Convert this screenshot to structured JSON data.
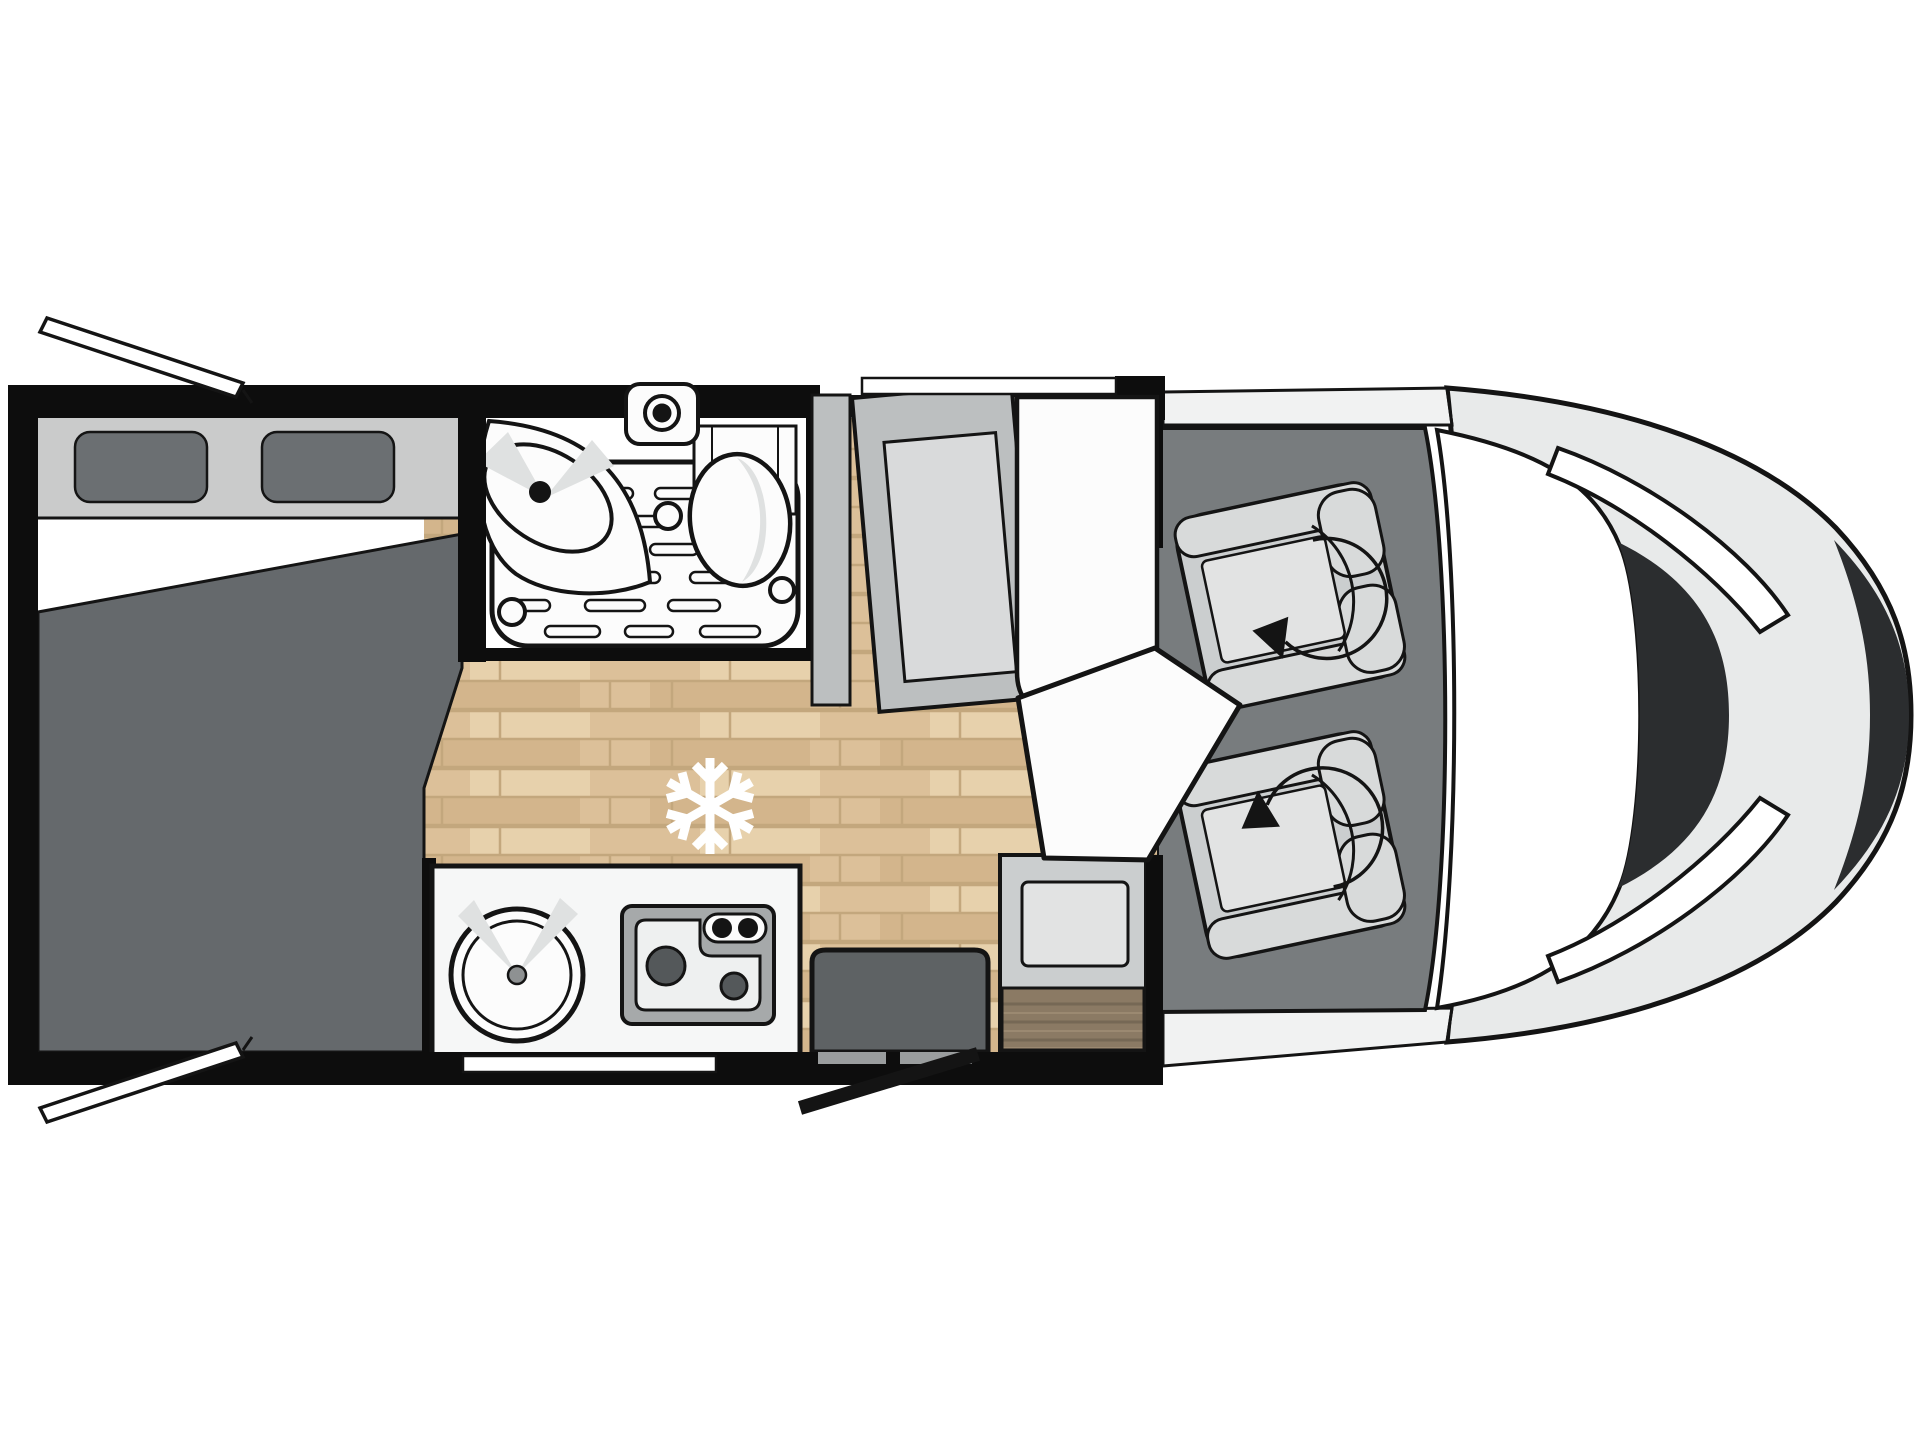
{
  "floorplan": {
    "vehicle_type": "motorhome",
    "view": "top-down motorhome floor plan, cab at right",
    "zones": [
      {
        "name": "rear-bed",
        "items": [
          "mattress",
          "headboard-shelf",
          "pillow-left",
          "pillow-right"
        ]
      },
      {
        "name": "bathroom",
        "items": [
          "corner-sink",
          "faucet",
          "toilet",
          "shower-tray",
          "shower-drains"
        ]
      },
      {
        "name": "kitchen",
        "items": [
          "round-sink",
          "two-burner-stove",
          "stove-knobs"
        ]
      },
      {
        "name": "living-area",
        "items": [
          "wardrobe",
          "wardrobe-door",
          "side-bench",
          "dinette-table",
          "dinette-bench",
          "bench-wood-top",
          "entry-step",
          "refrigerator-snowflake-icon",
          "wood-floor"
        ]
      },
      {
        "name": "cab",
        "items": [
          "passenger-swivel-seat",
          "driver-swivel-seat",
          "swivel-arrow-icon"
        ]
      },
      {
        "name": "vehicle-front",
        "items": [
          "windshield",
          "a-pillar-band",
          "hood",
          "headlight-upper",
          "headlight-lower",
          "front-grille"
        ]
      }
    ],
    "openings": [
      "rear-window-flap-top",
      "rear-window-flap-bottom",
      "top-wall-window",
      "kitchen-window",
      "entry-door-swing"
    ]
  },
  "palette": {
    "outline": "#141414",
    "wall": "#0d0d0d",
    "bed_gray": "#65696c",
    "pillow_gray": "#6b6f72",
    "headboard_gray": "#cacbcb",
    "cab_floor_gray": "#787c7e",
    "body_gray": "#e8eaea",
    "body_band": "#f1f2f2",
    "grille_dark": "#2b2d2f",
    "panel_gray": "#bcbfc0",
    "panel_inner": "#d9dadb",
    "seat_gray": "#cbcecf",
    "seat_pad": "#d8dada",
    "cushion": "#e2e3e3",
    "step_gray": "#5e6264",
    "counter_white": "#f6f7f7",
    "stove_frame": "#a6a9aa",
    "stove_inner": "#eef0f0",
    "burner_dark": "#54585a",
    "fixture_white": "#fcfcfc",
    "shade_gray": "#dfe1e1",
    "rail_gray": "#cfd1d2",
    "window_white": "#ffffff",
    "wood_base": "#dcc099",
    "wood_row": "#d3b58c",
    "wood_hi": "#e7d1ac",
    "wood_line": "#c3a77d",
    "woodbar_base": "#8b7a64",
    "woodbar_line": "#6f6150",
    "snowflake": "#ffffff"
  }
}
